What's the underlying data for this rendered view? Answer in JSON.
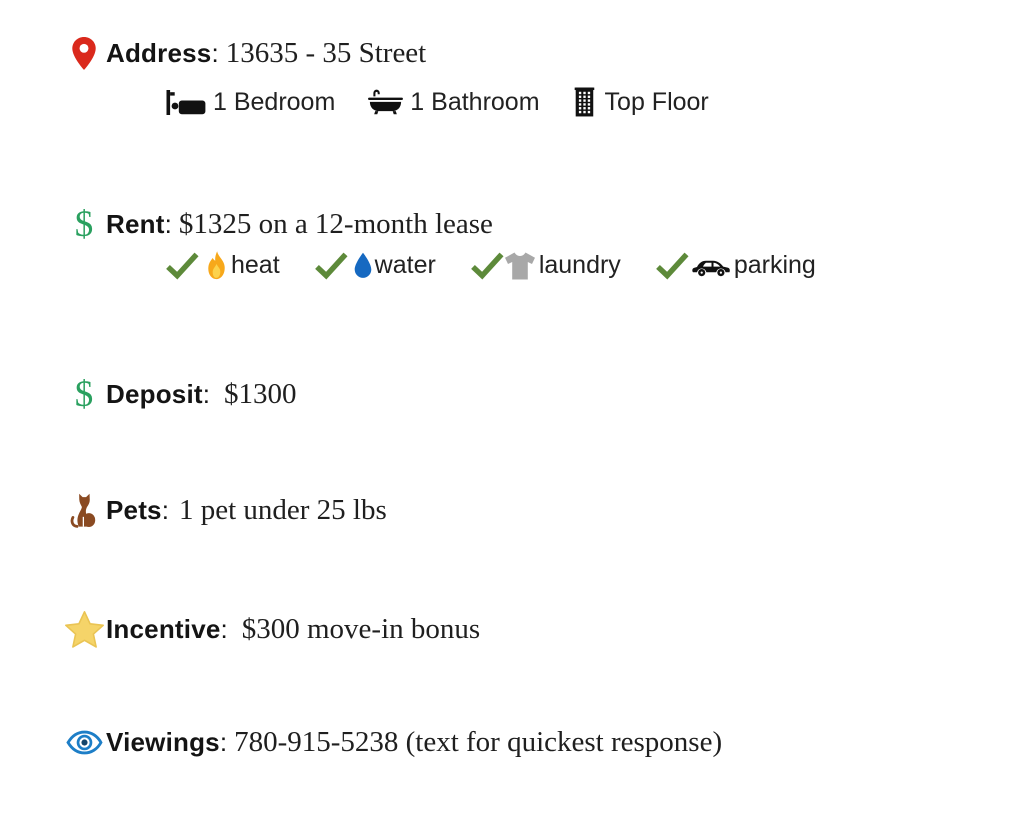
{
  "separator": ":",
  "icons": {
    "dollar_glyph": "$"
  },
  "colors": {
    "text": "#1c1c1c",
    "pin_red": "#da291c",
    "dollar_green": "#2aa05f",
    "check_green": "#5d8a3a",
    "flame_orange": "#f7a81b",
    "flame_yellow": "#fcd24c",
    "droplet_blue": "#1669c1",
    "tshirt_gray": "#a8a8a8",
    "icon_black": "#111111",
    "cat_brown": "#8a4a22",
    "star_gold": "#f5d469",
    "eye_blue": "#1d7ec7"
  },
  "sections": [
    {
      "label": "Address",
      "value": "13635 - 35 Street",
      "details": [
        {
          "icon": "bed-icon",
          "text": "1 Bedroom"
        },
        {
          "icon": "bathtub-icon",
          "text": "1 Bathroom"
        },
        {
          "icon": "building-icon",
          "text": "Top Floor"
        }
      ]
    },
    {
      "label": "Rent",
      "value": "$1325 on a 12-month lease",
      "features": [
        {
          "icon": "flame-icon",
          "text": "heat"
        },
        {
          "icon": "droplet-icon",
          "text": "water"
        },
        {
          "icon": "tshirt-icon",
          "text": "laundry"
        },
        {
          "icon": "car-icon",
          "text": "parking"
        }
      ]
    },
    {
      "label": "Deposit",
      "value": "$1300"
    },
    {
      "label": "Pets",
      "value": "1 pet under 25 lbs"
    },
    {
      "label": "Incentive",
      "value": "$300 move-in bonus"
    },
    {
      "label": "Viewings",
      "value": "780-915-5238 (text for quickest response)"
    }
  ]
}
